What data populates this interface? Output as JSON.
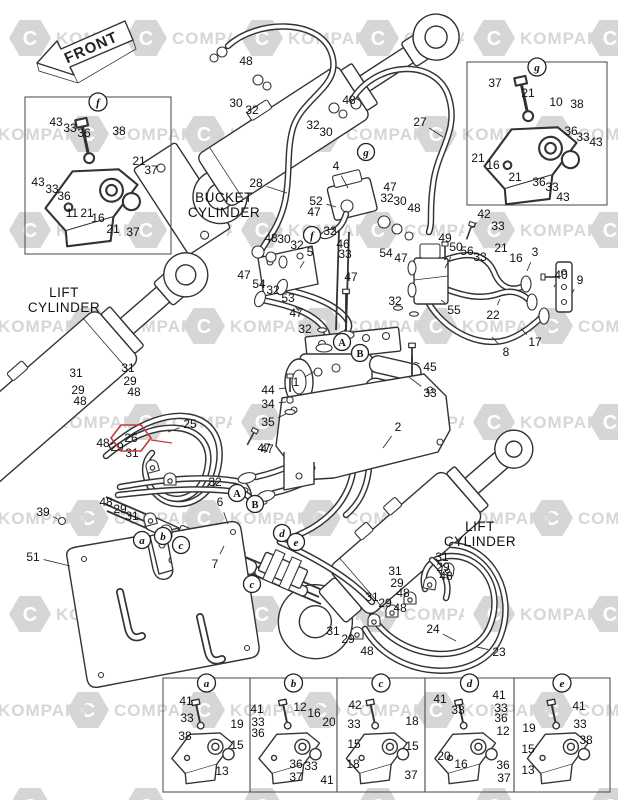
{
  "front_label": "FRONT",
  "watermark": {
    "words": [
      "KOMPART",
      "COMPART"
    ],
    "color": "#d6d6d6"
  },
  "highlight": {
    "label": "26",
    "x": 131,
    "y": 438,
    "leader": [
      172,
      443
    ],
    "color": "#c23b3b"
  },
  "area_labels": [
    {
      "lines": [
        "BUCKET",
        "CYLINDER"
      ],
      "x": 224,
      "y": 202
    },
    {
      "lines": [
        "LIFT",
        "CYLINDER"
      ],
      "x": 64,
      "y": 297
    },
    {
      "lines": [
        "LIFT",
        "CYLINDER"
      ],
      "x": 480,
      "y": 531
    }
  ],
  "detail_boxes": [
    {
      "letter": "f",
      "x": 25,
      "y": 97,
      "w": 146,
      "h": 157,
      "big": true
    },
    {
      "letter": "g",
      "x": 467,
      "y": 62,
      "w": 140,
      "h": 143,
      "big": true
    },
    {
      "letter": "a",
      "x": 163,
      "y": 678,
      "w": 87,
      "h": 114,
      "big": false
    },
    {
      "letter": "b",
      "x": 250,
      "y": 678,
      "w": 87,
      "h": 114,
      "big": false
    },
    {
      "letter": "c",
      "x": 337,
      "y": 678,
      "w": 88,
      "h": 114,
      "big": false
    },
    {
      "letter": "d",
      "x": 425,
      "y": 678,
      "w": 89,
      "h": 114,
      "big": false
    },
    {
      "letter": "e",
      "x": 514,
      "y": 678,
      "w": 96,
      "h": 114,
      "big": false
    }
  ],
  "ref_markers": [
    [
      "g",
      366,
      152
    ],
    [
      "f",
      312,
      235
    ],
    [
      "A",
      342,
      342
    ],
    [
      "B",
      360,
      353
    ],
    [
      "A",
      237,
      493
    ],
    [
      "B",
      255,
      504
    ],
    [
      "a",
      142,
      540
    ],
    [
      "b",
      163,
      536
    ],
    [
      "c",
      181,
      545
    ],
    [
      "d",
      282,
      533
    ],
    [
      "e",
      296,
      542
    ],
    [
      "c",
      252,
      584
    ]
  ],
  "part_labels": [
    [
      "48",
      246,
      61
    ],
    [
      "30",
      236,
      103
    ],
    [
      "32",
      252,
      110
    ],
    [
      "48",
      349,
      100
    ],
    [
      "32",
      313,
      125
    ],
    [
      "30",
      326,
      132
    ],
    [
      "27",
      420,
      122,
      443,
      137
    ],
    [
      "28",
      256,
      183,
      287,
      193
    ],
    [
      "43",
      56,
      122
    ],
    [
      "33",
      70,
      128
    ],
    [
      "36",
      84,
      133
    ],
    [
      "38",
      119,
      131
    ],
    [
      "21",
      139,
      161
    ],
    [
      "37",
      151,
      170
    ],
    [
      "43",
      38,
      182
    ],
    [
      "33",
      52,
      189
    ],
    [
      "36",
      64,
      196
    ],
    [
      "11",
      72,
      213
    ],
    [
      "21",
      87,
      213
    ],
    [
      "16",
      98,
      218
    ],
    [
      "21",
      113,
      229
    ],
    [
      "37",
      133,
      232
    ],
    [
      "37",
      495,
      83
    ],
    [
      "21",
      528,
      93
    ],
    [
      "10",
      556,
      102
    ],
    [
      "38",
      577,
      104
    ],
    [
      "36",
      571,
      131
    ],
    [
      "33",
      583,
      137
    ],
    [
      "43",
      596,
      142
    ],
    [
      "21",
      478,
      158
    ],
    [
      "16",
      493,
      165
    ],
    [
      "21",
      515,
      177
    ],
    [
      "36",
      539,
      182
    ],
    [
      "33",
      552,
      187
    ],
    [
      "43",
      563,
      197
    ],
    [
      "4",
      336,
      166,
      348,
      188
    ],
    [
      "52",
      316,
      201,
      336,
      207
    ],
    [
      "47",
      390,
      187
    ],
    [
      "47",
      314,
      212
    ],
    [
      "32",
      387,
      198
    ],
    [
      "30",
      400,
      201
    ],
    [
      "48",
      414,
      208
    ],
    [
      "42",
      484,
      214,
      472,
      228
    ],
    [
      "33",
      498,
      226
    ],
    [
      "49",
      445,
      238
    ],
    [
      "50",
      456,
      247,
      445,
      268
    ],
    [
      "56",
      467,
      251
    ],
    [
      "33",
      480,
      257
    ],
    [
      "21",
      501,
      248
    ],
    [
      "16",
      516,
      258
    ],
    [
      "3",
      535,
      252,
      527,
      271
    ],
    [
      "40",
      561,
      275,
      554,
      287
    ],
    [
      "9",
      580,
      280,
      572,
      293
    ],
    [
      "32",
      330,
      231
    ],
    [
      "46",
      343,
      244
    ],
    [
      "33",
      345,
      254
    ],
    [
      "48",
      271,
      238
    ],
    [
      "30",
      284,
      239
    ],
    [
      "32",
      297,
      245
    ],
    [
      "5",
      310,
      252,
      300,
      268
    ],
    [
      "47",
      244,
      275
    ],
    [
      "54",
      259,
      284
    ],
    [
      "32",
      273,
      290
    ],
    [
      "53",
      288,
      298,
      299,
      311
    ],
    [
      "47",
      351,
      277
    ],
    [
      "47",
      296,
      313
    ],
    [
      "32",
      305,
      329
    ],
    [
      "54",
      386,
      253
    ],
    [
      "47",
      401,
      258
    ],
    [
      "32",
      395,
      301
    ],
    [
      "55",
      454,
      310,
      441,
      300
    ],
    [
      "22",
      493,
      315,
      500,
      299
    ],
    [
      "17",
      535,
      342,
      521,
      329
    ],
    [
      "8",
      506,
      352,
      492,
      337
    ],
    [
      "45",
      430,
      367,
      414,
      362
    ],
    [
      "33",
      430,
      393,
      409,
      377
    ],
    [
      "1",
      296,
      382,
      315,
      371
    ],
    [
      "2",
      398,
      427,
      383,
      448
    ],
    [
      "44",
      268,
      390,
      286,
      388
    ],
    [
      "34",
      268,
      404,
      286,
      402
    ],
    [
      "35",
      268,
      422,
      286,
      414
    ],
    [
      "47",
      267,
      449
    ],
    [
      "31",
      76,
      373
    ],
    [
      "31",
      128,
      368
    ],
    [
      "29",
      78,
      390
    ],
    [
      "29",
      130,
      381
    ],
    [
      "48",
      80,
      401
    ],
    [
      "48",
      134,
      392
    ],
    [
      "25",
      190,
      424,
      168,
      432
    ],
    [
      "48",
      103,
      443
    ],
    [
      "29",
      117,
      447
    ],
    [
      "31",
      132,
      453
    ],
    [
      "48",
      106,
      502
    ],
    [
      "29",
      120,
      509
    ],
    [
      "31",
      132,
      516
    ],
    [
      "39",
      43,
      512,
      58,
      519
    ],
    [
      "51",
      33,
      557,
      70,
      566
    ],
    [
      "6",
      220,
      502,
      228,
      524
    ],
    [
      "7",
      215,
      564,
      224,
      546
    ],
    [
      "32",
      215,
      482
    ],
    [
      "47",
      264,
      448
    ],
    [
      "31",
      442,
      557
    ],
    [
      "29",
      443,
      567
    ],
    [
      "48",
      446,
      576
    ],
    [
      "31",
      395,
      571
    ],
    [
      "29",
      397,
      583
    ],
    [
      "48",
      403,
      593
    ],
    [
      "31",
      372,
      597
    ],
    [
      "29",
      385,
      603
    ],
    [
      "48",
      400,
      608
    ],
    [
      "31",
      333,
      631
    ],
    [
      "29",
      348,
      639
    ],
    [
      "48",
      367,
      651
    ],
    [
      "24",
      433,
      629,
      456,
      641
    ],
    [
      "23",
      499,
      652,
      477,
      647
    ],
    [
      "41",
      186,
      701
    ],
    [
      "33",
      187,
      718
    ],
    [
      "19",
      237,
      724
    ],
    [
      "38",
      185,
      736
    ],
    [
      "15",
      237,
      745
    ],
    [
      "13",
      222,
      771
    ],
    [
      "41",
      257,
      709
    ],
    [
      "33",
      258,
      722
    ],
    [
      "36",
      258,
      733
    ],
    [
      "12",
      300,
      707
    ],
    [
      "16",
      314,
      713
    ],
    [
      "20",
      329,
      722
    ],
    [
      "36",
      296,
      764
    ],
    [
      "33",
      311,
      766
    ],
    [
      "37",
      296,
      777
    ],
    [
      "41",
      327,
      780
    ],
    [
      "42",
      355,
      705
    ],
    [
      "33",
      354,
      724
    ],
    [
      "18",
      412,
      721
    ],
    [
      "15",
      354,
      744
    ],
    [
      "15",
      412,
      746
    ],
    [
      "18",
      353,
      764
    ],
    [
      "37",
      411,
      775
    ],
    [
      "41",
      440,
      699
    ],
    [
      "33",
      458,
      710
    ],
    [
      "41",
      499,
      695
    ],
    [
      "33",
      501,
      708
    ],
    [
      "36",
      501,
      718
    ],
    [
      "12",
      503,
      731
    ],
    [
      "20",
      444,
      756
    ],
    [
      "16",
      461,
      764
    ],
    [
      "36",
      503,
      765
    ],
    [
      "37",
      504,
      778
    ],
    [
      "41",
      579,
      706
    ],
    [
      "33",
      580,
      724
    ],
    [
      "19",
      529,
      728
    ],
    [
      "38",
      586,
      740
    ],
    [
      "15",
      528,
      749
    ],
    [
      "13",
      528,
      770
    ]
  ]
}
